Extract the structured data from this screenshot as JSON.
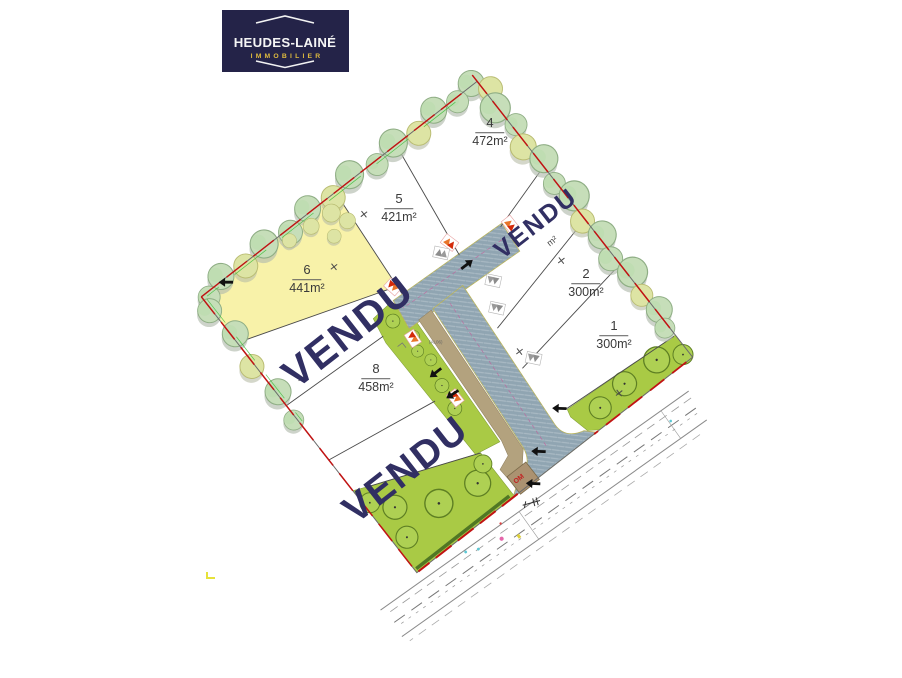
{
  "logo": {
    "title": "HEUDES-LAINÉ",
    "subtitle": "IMMOBILIER"
  },
  "plan": {
    "sold_label": "VENDU",
    "lots": {
      "lot1": {
        "number": "1",
        "area": "300m²"
      },
      "lot2": {
        "number": "2",
        "area": "300m²"
      },
      "lot3": {
        "status": "VENDU",
        "area_fragment": "m²"
      },
      "lot4": {
        "number": "4",
        "area": "472m²"
      },
      "lot5": {
        "number": "5",
        "area": "421m²"
      },
      "lot6": {
        "number": "6",
        "area": "441m²"
      },
      "lot7": {
        "status": "VENDU"
      },
      "lot8": {
        "number": "8",
        "area": "458m²"
      },
      "lot9": {
        "status": "VENDU"
      }
    },
    "annotations": {
      "bin_area": "OM",
      "parcel_ref": "(AL06)"
    },
    "colors": {
      "sold_text": "#312f63",
      "boundary_red": "#c11313",
      "road": "#90a5b2",
      "lot6_fill": "#f8f2a9",
      "green_strip": "#a9ca45",
      "logo_bg": "#242348",
      "logo_gold": "#dfbb3e"
    }
  }
}
